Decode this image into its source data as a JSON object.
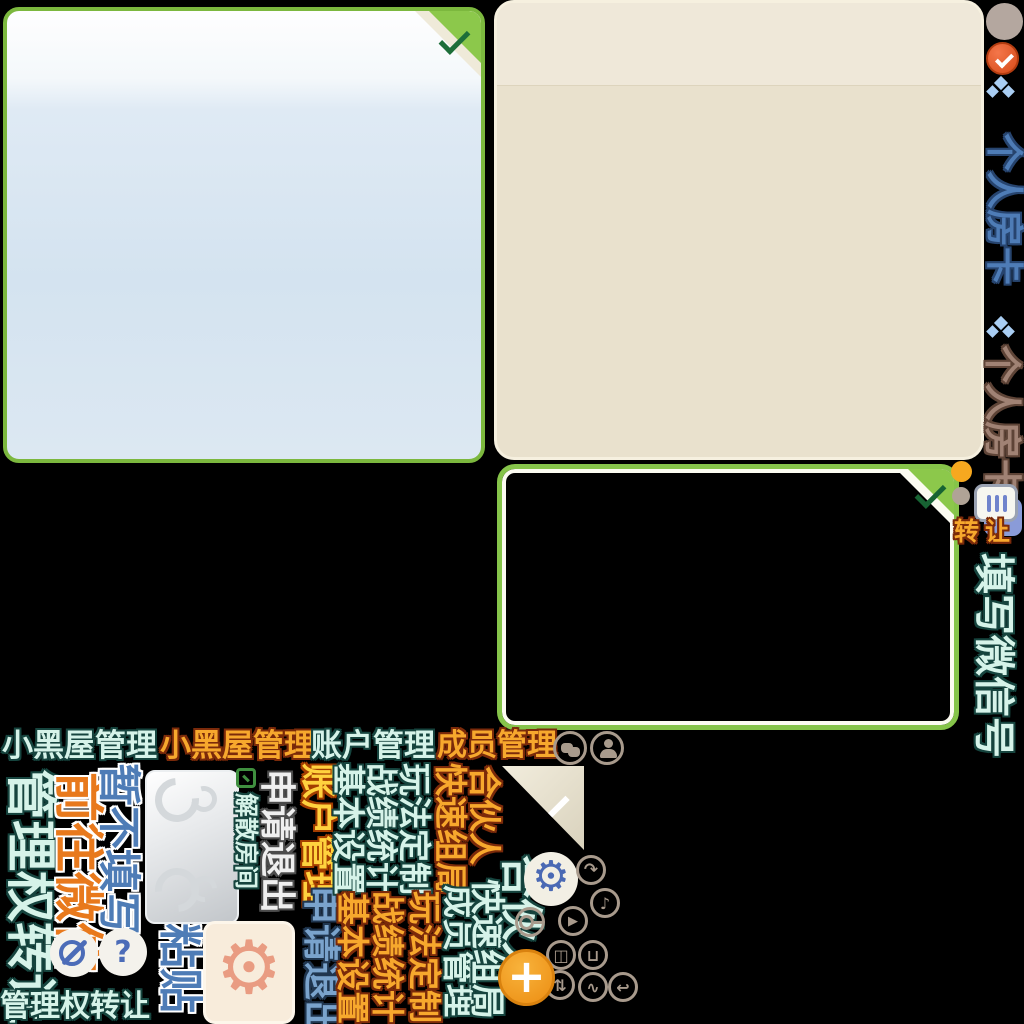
{
  "colors": {
    "background": "#000000",
    "panel_border_green": "#7cb83e",
    "fold_green": "#8cc84b",
    "check_dark_green": "#1d6e39",
    "panel_beige": "#e9e1cd",
    "panel_beige_header": "#efe8d9",
    "text_cyan": "#d6f3e9",
    "text_cyan_outline": "#16443e",
    "text_orange": "#f7a82d",
    "text_blue": "#4e7cb6",
    "icon_taupe": "#a89a8c",
    "alert_orange_circle": "#e8542a",
    "plus_orange": "#f0941e",
    "gear_salmon": "#e99c82",
    "gear_blue": "#4a69b4"
  },
  "right_rail": {
    "tab_active": "个人房卡",
    "tab_inactive": "个人房卡",
    "transfer": "转让",
    "fill_wechat": "填写微信号"
  },
  "nav": {
    "blackroom_a": "小黑屋管理",
    "blackroom_b": "小黑屋管理",
    "account": "账户管理",
    "member": "成员管理"
  },
  "wechat_prompt": {
    "skip": "暂不填写",
    "goto": "前往微信"
  },
  "transfer_section": {
    "title_vertical": "管理权转让",
    "title_bottom": "管理权转让",
    "paste": "粘贴"
  },
  "room_actions": {
    "dismiss": "解散房间",
    "exit_silver": "申请退出",
    "account_yellow": "账户管理",
    "exit_blue": "申请退出"
  },
  "menu": {
    "basic_a": "基本设置",
    "stats_a": "战绩统计",
    "rules_a": "玩法定制",
    "quick_a": "快速组局",
    "partner_a": "合伙人",
    "basic_b": "基本设置",
    "stats_b": "战绩统计",
    "rules_b": "玩法定制",
    "member_b": "成员管理",
    "quick_b": "快速组局",
    "partner_b": "合伙人"
  },
  "icon_glyphs": {
    "gear": "⚙",
    "play": "▶",
    "redo": "↷",
    "sort": "⇅",
    "back": "↩",
    "note": "♪",
    "door": "◫",
    "pot": "⊔",
    "wave": "∿",
    "plus": "+",
    "question": "?"
  }
}
